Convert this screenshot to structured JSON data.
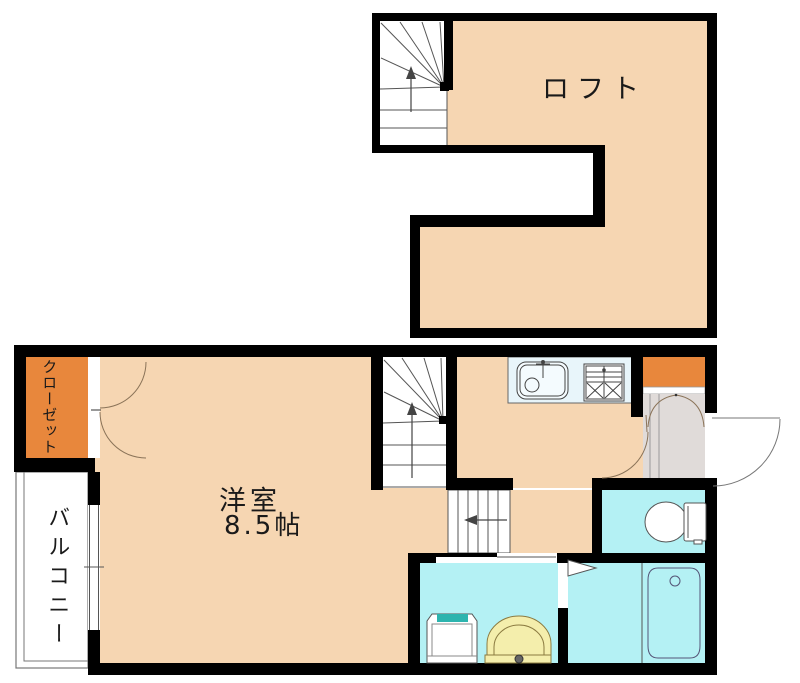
{
  "floor_plan": {
    "title": "apartment-floor-plan",
    "loft": {
      "label": "ロフト"
    },
    "main_floor": {
      "room_label": "洋室",
      "room_size": "8.5帖",
      "closet_label": "クローゼット",
      "balcony_label": "バルコニー"
    },
    "fixtures": [
      "staircase-winder-up",
      "staircase-lower-flight",
      "kitchen-sink",
      "gas-stove",
      "shoe-cabinet",
      "entrance-door",
      "hall-door",
      "closet-double-doors",
      "balcony-window",
      "toilet",
      "bathtub",
      "washbasin",
      "washing-machine-pan",
      "bath-folding-door",
      "washroom-sliding-door"
    ],
    "colors": {
      "floor_peach": "#f6d6b2",
      "closet_orange": "#e8873c",
      "wet_area_cyan": "#b4f1f4",
      "kitchen_counter": "#e8f5fa",
      "entrance_gray": "#e0dbd9",
      "washbasin_yellow": "#f4eeac",
      "washer_teal": "#2cb4ae",
      "wall_black": "#000000",
      "line_gray": "#555555",
      "door_arc_brown": "#8a7358"
    }
  }
}
